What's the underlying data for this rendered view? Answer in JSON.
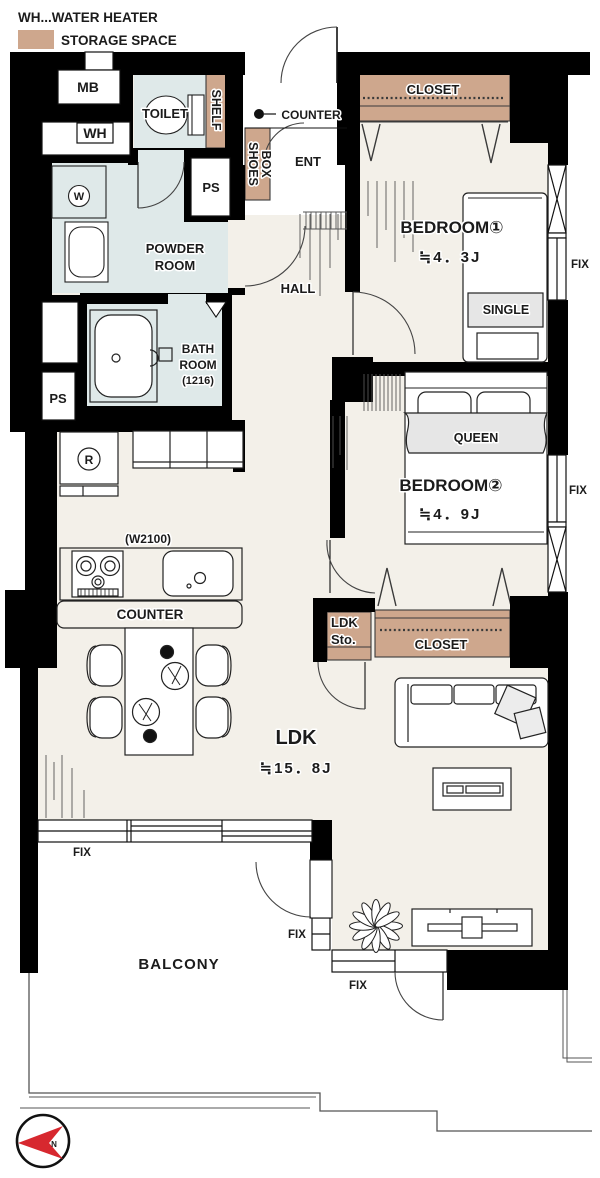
{
  "legend": {
    "water_heater": "WH...WATER HEATER",
    "storage": "STORAGE SPACE"
  },
  "colors": {
    "wall": "#000000",
    "floor": "#F3F0E9",
    "wet_area": "#DFE9E9",
    "storage": "#CEA78D",
    "north_arrow": "#D7282F"
  },
  "rooms": {
    "toilet": "TOILET",
    "powder_room": {
      "line1": "POWDER",
      "line2": "ROOM"
    },
    "bath_room": {
      "line1": "BATH",
      "line2": "ROOM",
      "size": "(1216)"
    },
    "hall": "HALL",
    "entrance": "ENT",
    "bedroom1": {
      "name": "BEDROOM①",
      "size": "≒4．3J"
    },
    "bedroom2": {
      "name": "BEDROOM②",
      "size": "≒4．9J"
    },
    "ldk": {
      "name": "LDK",
      "size": "≒15．8J"
    },
    "balcony": "BALCONY"
  },
  "fixtures": {
    "meter_box": "MB",
    "water_heater": "WH",
    "shelf": "SHELF",
    "shoes_box": {
      "line1": "SHOES",
      "line2": "BOX"
    },
    "entry_counter": "COUNTER",
    "pipe_space": "PS",
    "washer": "W",
    "refrigerator": "R",
    "kitchen_width": "(W2100)",
    "kitchen_counter": "COUNTER",
    "closet": "CLOSET",
    "ldk_storage": {
      "line1": "LDK",
      "line2": "Sto."
    },
    "single_bed": "SINGLE",
    "queen_bed": "QUEEN",
    "fix_window": "FIX",
    "north": "N"
  }
}
